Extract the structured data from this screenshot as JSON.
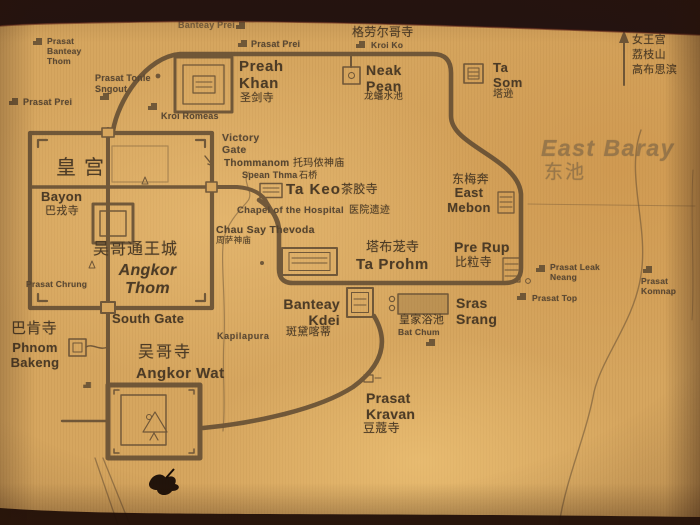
{
  "sites": {
    "banteay_prei": {
      "en": "Banteay Prei"
    },
    "prasat_prei_north": {
      "en": "Prasat Prei"
    },
    "prasat_banteay_thom": {
      "en": "Prasat\nBanteay\nThom"
    },
    "prasat_tonle_sngout": {
      "en": "Prasat Tonle\nSngout"
    },
    "prasat_prei_west": {
      "en": "Prasat Prei"
    },
    "kroi_romeas": {
      "en": "Kroi Romeas"
    },
    "kroi_ko": {
      "en": "Kroi Ko",
      "zh": "格劳尔哥寺"
    },
    "preah_khan": {
      "en": "Preah\nKhan",
      "zh": "圣剑寺"
    },
    "neak_pean": {
      "en": "Neak\nPean",
      "zh": "龙蟠水池"
    },
    "ta_som": {
      "en": "Ta\nSom",
      "zh": "塔逊"
    },
    "banteay_srei_direction": {
      "zh1": "女王宫",
      "zh2": "荔枝山",
      "zh3": "高布思滨"
    },
    "east_baray": {
      "en": "East Baray",
      "zh": "东池"
    },
    "east_mebon": {
      "en": "East\nMebon",
      "zh": "东梅奔"
    },
    "pre_rup": {
      "en": "Pre Rup",
      "zh": "比粒寺"
    },
    "prasat_leak_neang": {
      "en": "Prasat Leak\nNeang"
    },
    "prasat_komnap": {
      "en": "Prasat\nKomnap"
    },
    "prasat_top": {
      "en": "Prasat Top"
    },
    "victory_gate": {
      "en": "Victory\nGate"
    },
    "thommanom": {
      "en": "Thommanom",
      "zh": "托玛侬神庙"
    },
    "spean_thma": {
      "en": "Spean Thma",
      "zh": "石桥"
    },
    "ta_keo": {
      "en": "Ta Keo",
      "zh": "茶胶寺"
    },
    "chapel_of_the_hospital": {
      "en": "Chapel of the Hospital",
      "zh": "医院遗迹"
    },
    "chau_say_thevoda": {
      "en": "Chau Say Thevoda",
      "zh": "周萨神庙"
    },
    "ta_prohm": {
      "en": "Ta Prohm",
      "zh": "塔布茏寺"
    },
    "banteay_kdei": {
      "en": "Banteay\nKdei",
      "zh": "斑黛喀蒂"
    },
    "sras_srang": {
      "en": "Sras\nSrang",
      "zh": "皇家浴池"
    },
    "bat_chum": {
      "en": "Bat Chum"
    },
    "south_gate": {
      "en": "South Gate"
    },
    "phnom_bakeng": {
      "en": "Phnom\nBakeng",
      "zh": "巴肯寺"
    },
    "angkor_wat": {
      "en": "Angkor Wat",
      "zh": "吴哥寺"
    },
    "prasat_kravan": {
      "en": "Prasat\nKravan",
      "zh": "豆蔻寺"
    },
    "angkor_thom": {
      "en": "Angkor\nThom",
      "zh": "吴哥通王城"
    },
    "royal_palace": {
      "zh": "皇宫"
    },
    "bayon": {
      "en": "Bayon",
      "zh": "巴戎寺"
    },
    "prasat_chrung": {
      "en": "Prasat Chrung"
    },
    "kapilapura": {
      "en": "Kapilapura"
    }
  },
  "colors": {
    "paper": "#d5a45c",
    "ink": "#4c3b26",
    "road": "#5a4630",
    "photo_border": "#241310",
    "engraved_text": "#8d7048"
  },
  "icons": {
    "site-icon": "stepped-block",
    "direction-arrow-icon": "↑",
    "victory-gate-arrow-icon": "↘"
  }
}
